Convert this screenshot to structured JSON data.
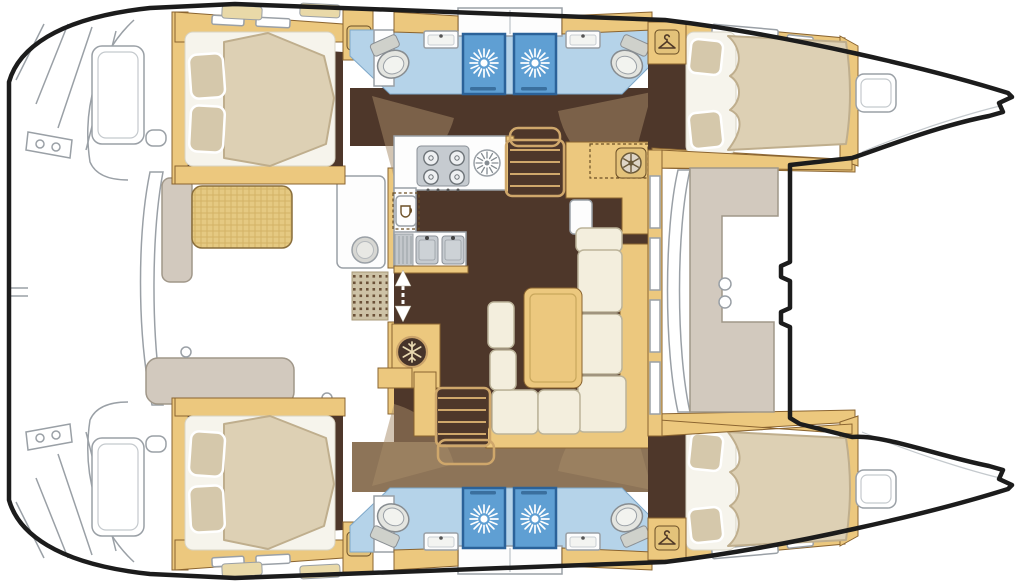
{
  "page": {
    "width": 1024,
    "height": 582,
    "background": "#ffffff"
  },
  "diagram": {
    "type": "boat deck floor plan",
    "vessel": "sailing catamaran",
    "orientation": {
      "bow": "right",
      "stern": "left"
    },
    "layout_summary": {
      "double_cabins": 4,
      "heads_with_toilet_and_basin": 4,
      "shower_stalls": 4,
      "wardrobes": 4,
      "galley_burners": 4,
      "galley_sinks": 2,
      "salon_table": 1,
      "companionway_stairs": 2,
      "bow_deck_hatches": 2,
      "swim_platforms": 2,
      "cockpits": [
        "aft cockpit",
        "forward cockpit lounge"
      ]
    }
  },
  "icons": {
    "hanger-icon": "wardrobe / hanging locker",
    "shower-spray-icon": "shower stall",
    "toilet-icon": "marine toilet",
    "sink-icon": "washbasin",
    "stove-icon": "4-burner cooktop",
    "vent-fan-icon": "galley hatch fan",
    "fridge-icon": "refrigerator",
    "snowflake-icon": "freezer / cool box",
    "instrument-icon": "nav-station instrument",
    "double-arrow-icon": "sliding door to aft cockpit",
    "door-swing-arc": "door swing",
    "deck-hatch-icon": "deck hatch",
    "washer-icon": "round appliance / wet-bar basin"
  },
  "colors": {
    "hull_outline": "#1c1c1c",
    "detail_line": "#9aa0a6",
    "wood": "#ecc87e",
    "wood_edge": "#8a6430",
    "wood_pale": "#e9d9a8",
    "floor_dark": "#4e372a",
    "floor_mid": "#8d7458",
    "door_fan": "#a88b67",
    "bath_floor": "#b5d3e9",
    "shower_fill": "#5f9fd3",
    "shower_edge": "#2b6299",
    "mattress": "#ddd0b4",
    "mattress_edge": "#bfae8d",
    "pillow": "#d5c8ab",
    "sofa": "#f3eedd",
    "sofa_edge": "#bcb49a",
    "taupe": "#d2c9be",
    "taupe_edge": "#a09789",
    "fixture_white": "#fdfdfd",
    "steel": "#c6cbd0",
    "canvas": "#e5c982"
  }
}
